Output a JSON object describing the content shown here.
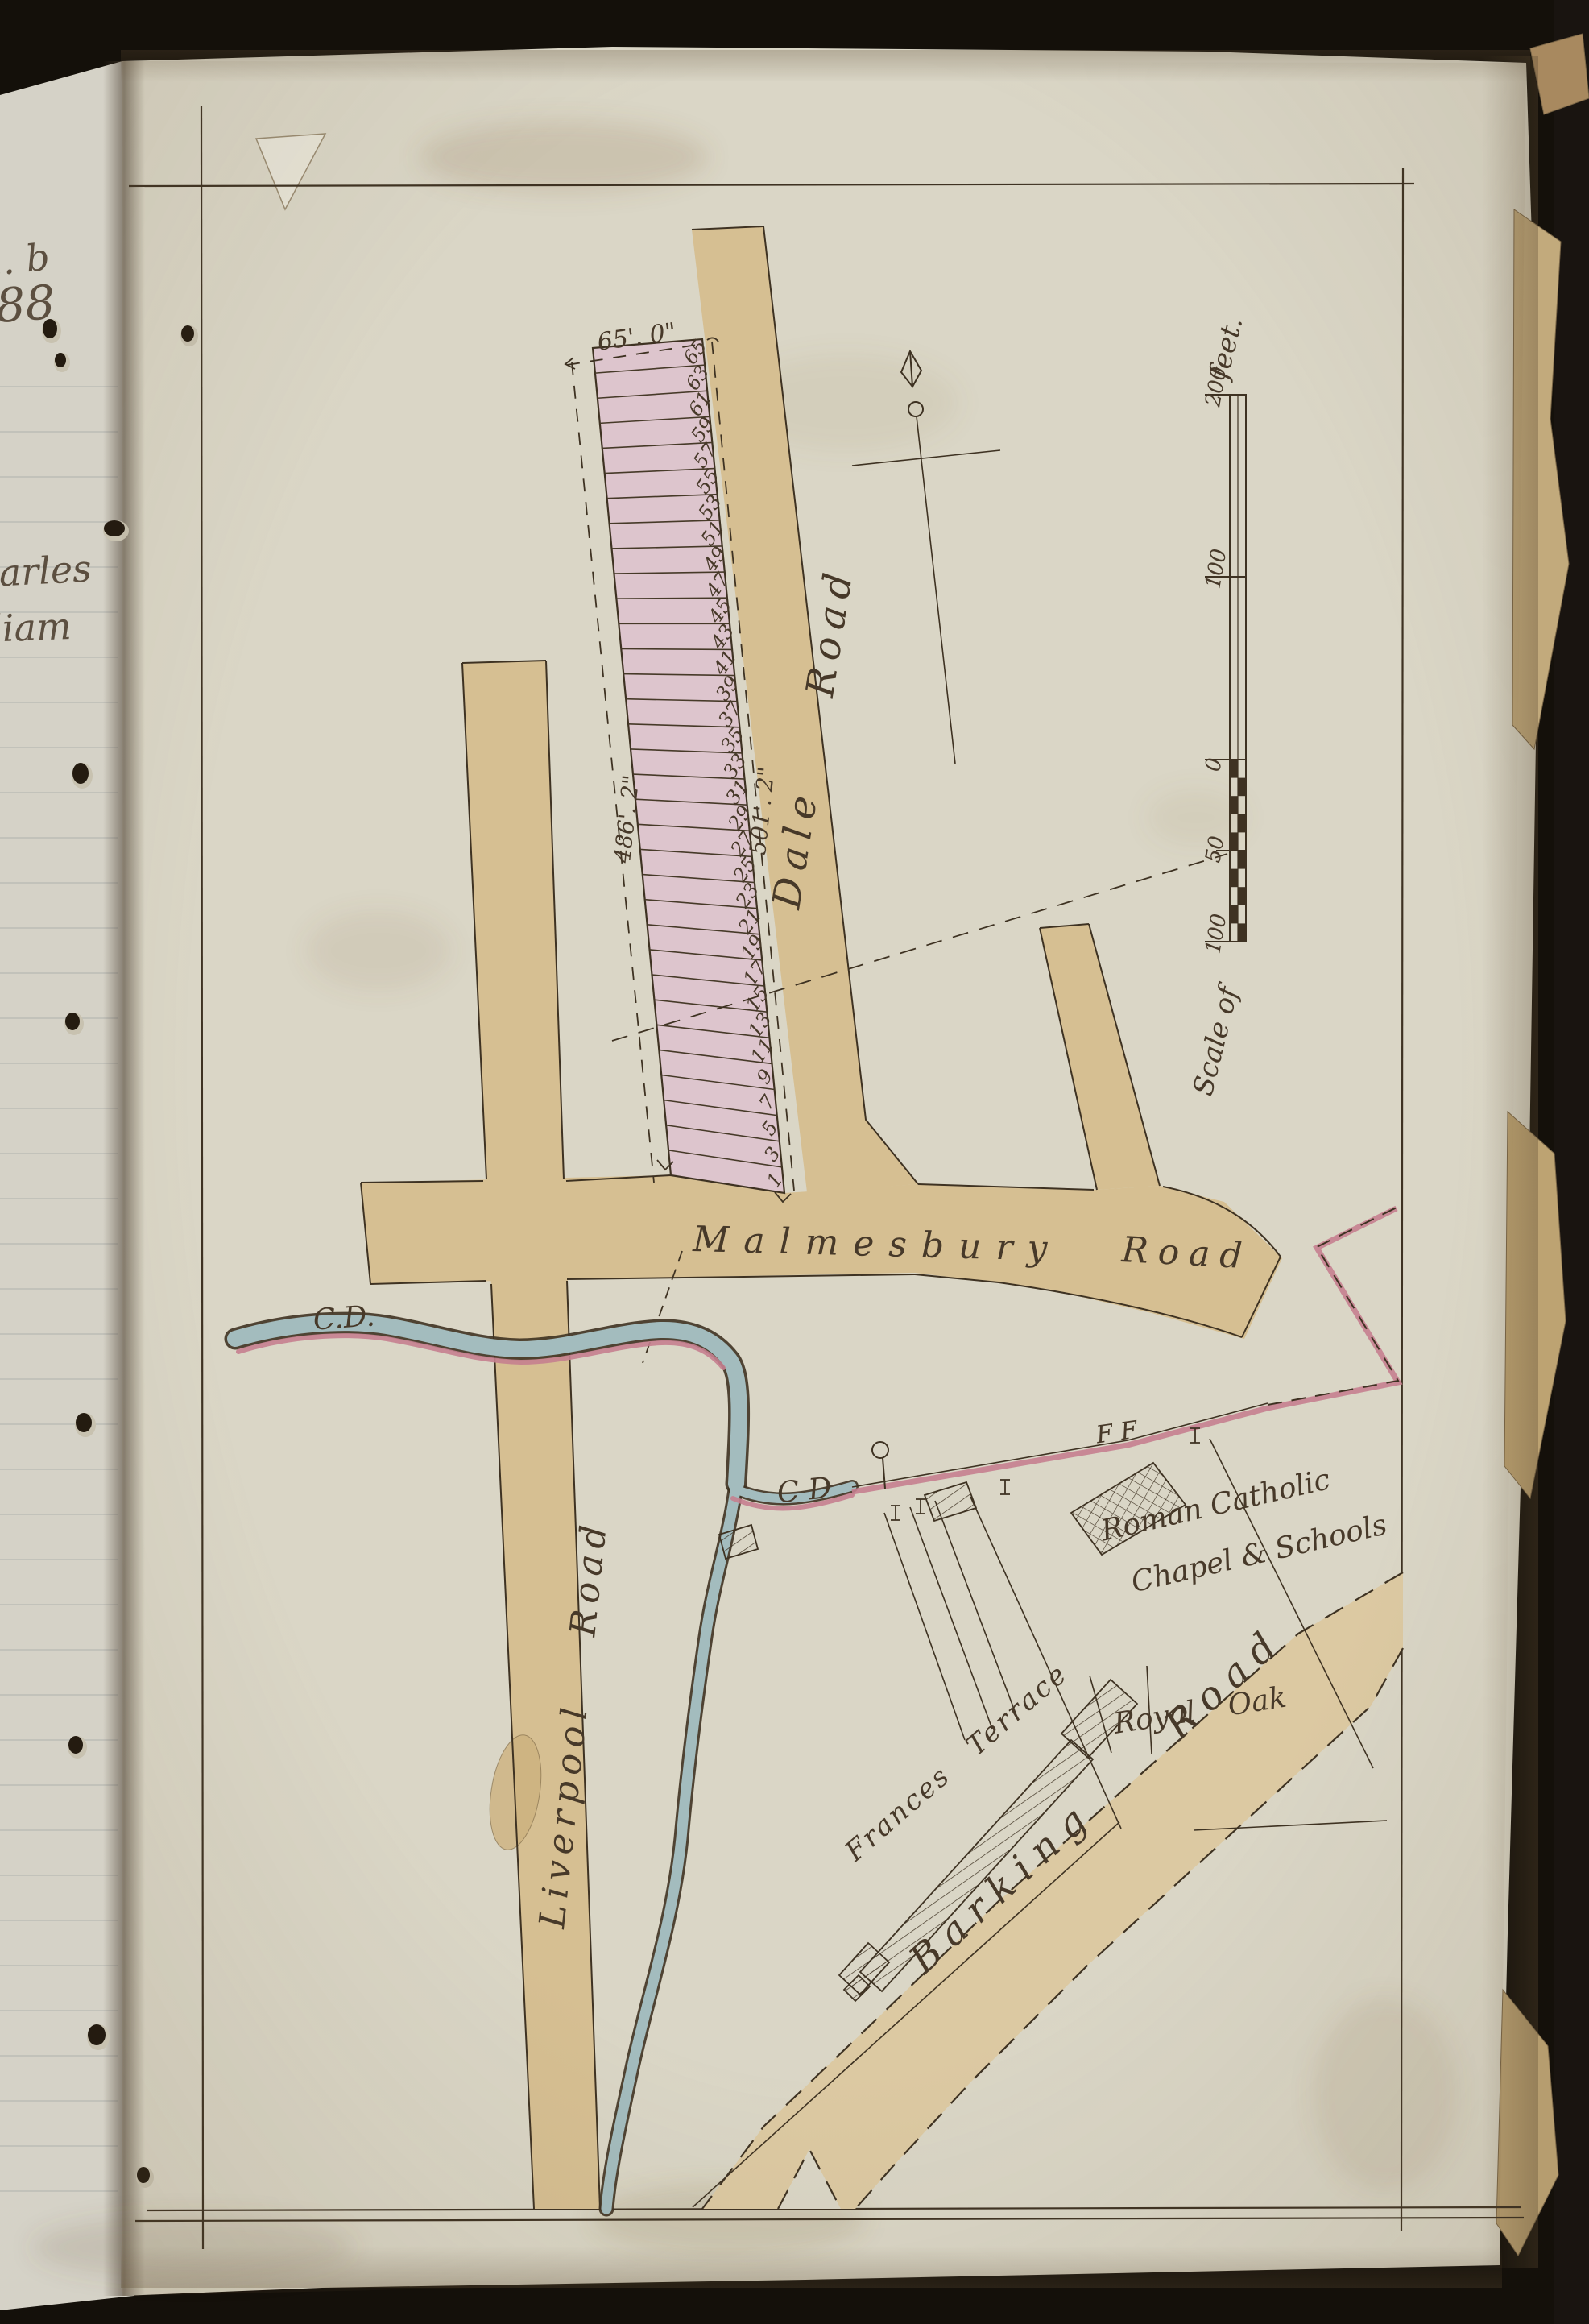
{
  "palette": {
    "cover": "#14100a",
    "paper": "#dad6c6",
    "paper_left": "#d5d2c7",
    "road_tan": "#d6bf92",
    "plot_pink": "#ddc5cd",
    "stream_blue": "#a3bcbe",
    "boundary_pink": "#c5808f",
    "ink": "#43362a"
  },
  "left_page": {
    "fragment_1": "l. b",
    "fragment_2": "88",
    "fragment_3": "harles",
    "fragment_4": "lliam"
  },
  "map": {
    "roads": {
      "dale": "Dale Road",
      "malmesbury_w1": "Malmesbury",
      "malmesbury_w2": "Road",
      "liverpool": "Liverpool Road",
      "barking": "Barking Road"
    },
    "labels": {
      "cd_upper": "C.D.",
      "cd_lower": "C D",
      "ff": "F F",
      "chapel_line1": "Roman Catholic",
      "chapel_line2": "Chapel & Schools",
      "terrace": "Frances Terrace",
      "royal_oak": "Royal Oak"
    },
    "dimensions": {
      "frontage": "65'. 0\"",
      "side_left": "486'. 2\"",
      "side_right": "501'. 2\""
    },
    "plot_numbers": [
      1,
      3,
      5,
      7,
      9,
      11,
      13,
      15,
      17,
      19,
      21,
      23,
      25,
      27,
      29,
      31,
      33,
      35,
      37,
      39,
      41,
      43,
      45,
      47,
      49,
      51,
      53,
      55,
      57,
      59,
      61,
      63,
      65
    ],
    "scale_bar": {
      "label_top": "feet.",
      "label_bottom": "Scale of",
      "ticks": [
        "200",
        "100",
        "0",
        "50",
        "100"
      ]
    }
  }
}
